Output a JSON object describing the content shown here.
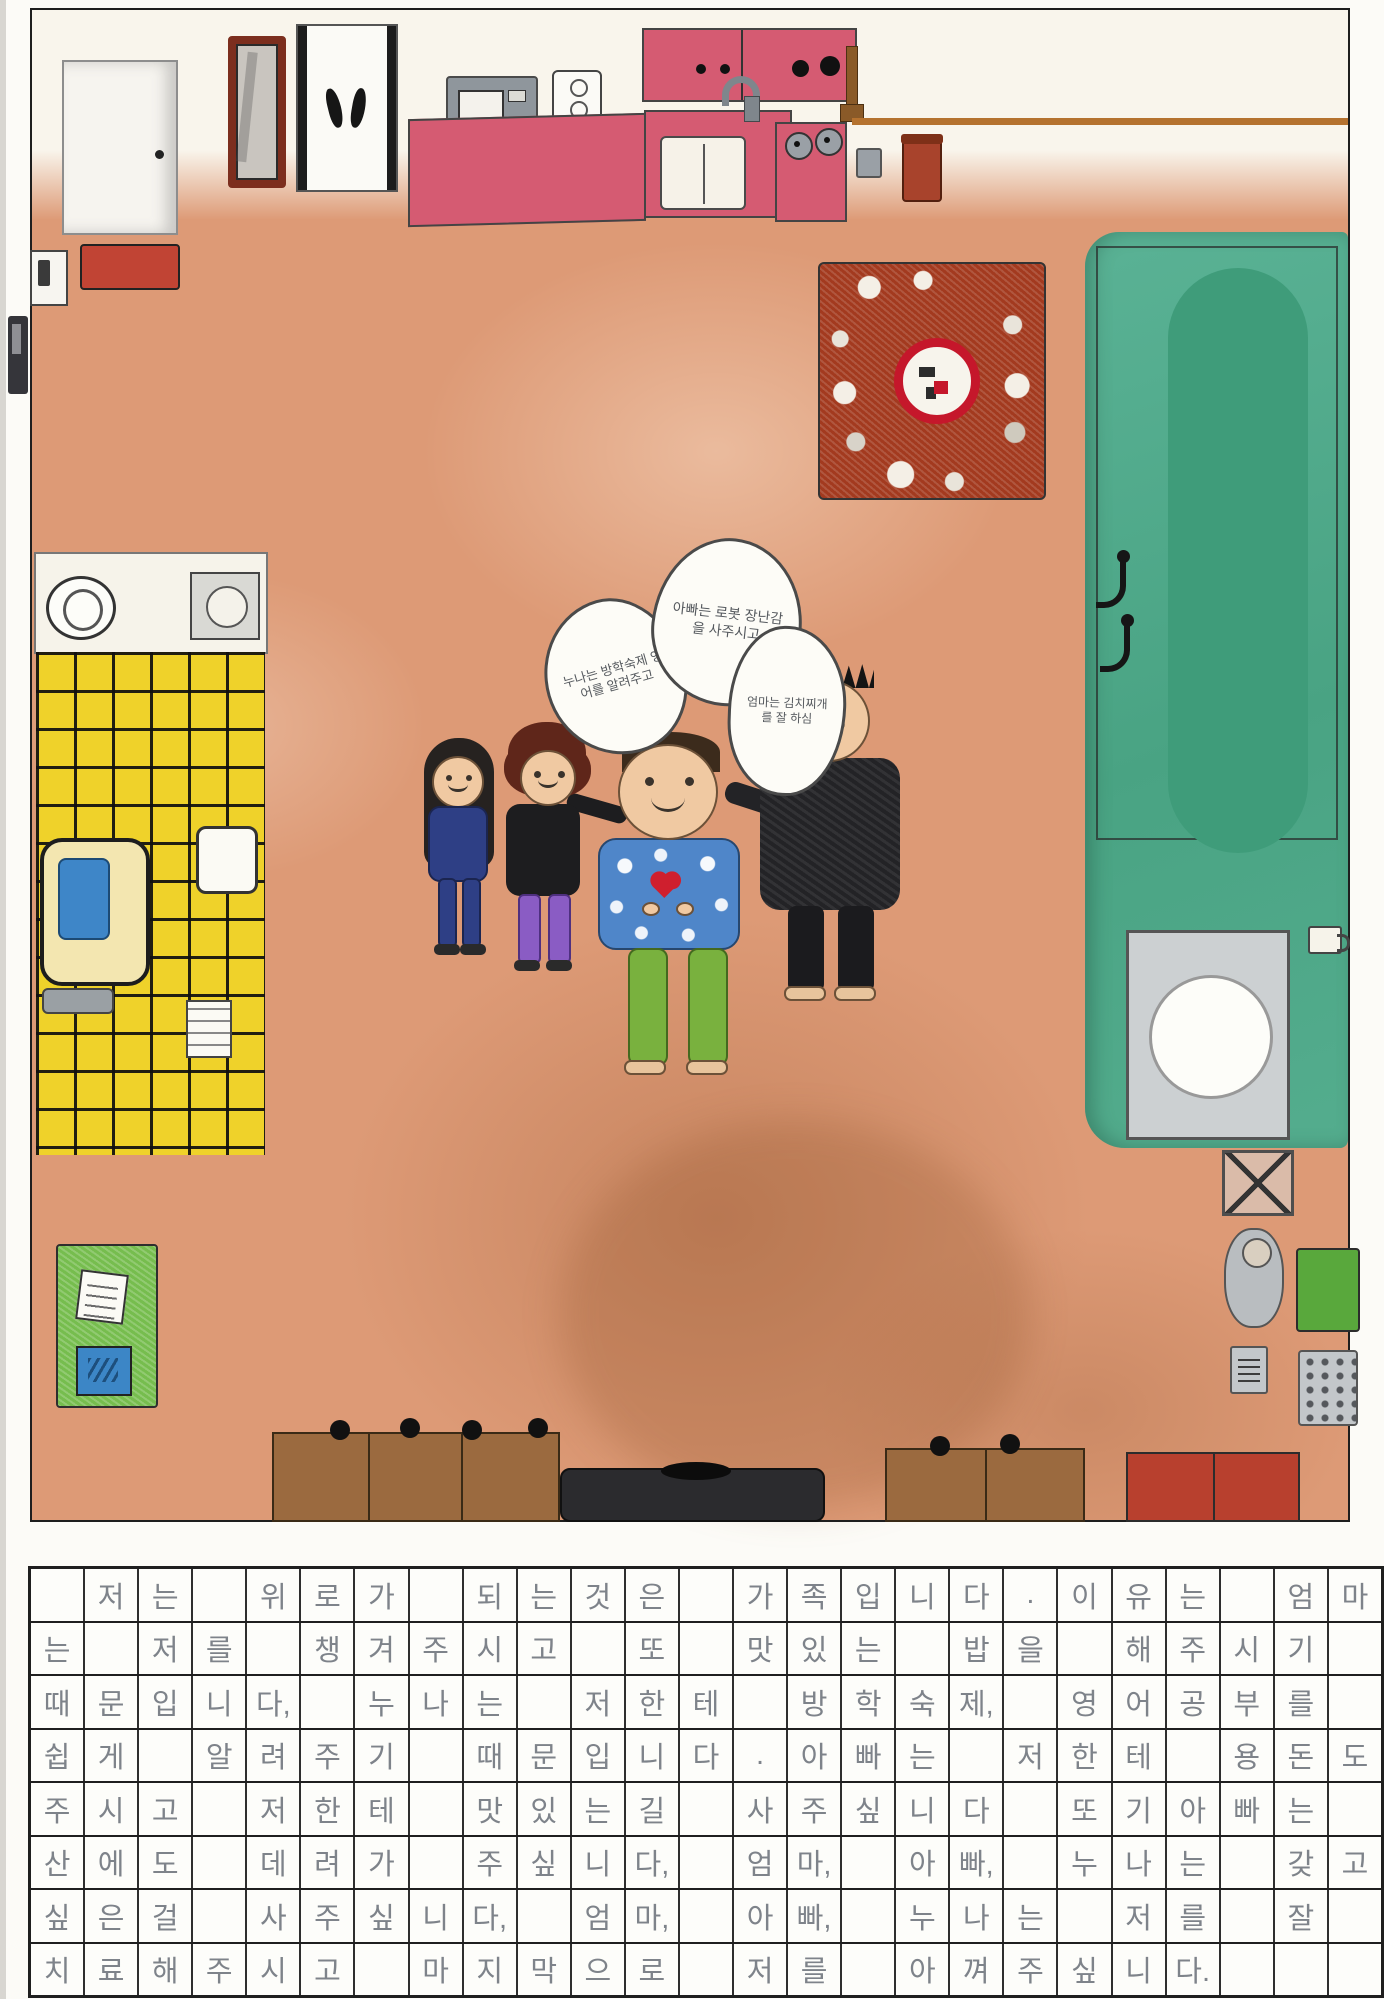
{
  "drawing": {
    "speech_bubbles": {
      "sister_bubble": "누나는 방학숙제 영어를 알려주고",
      "dad_bubble": "아빠는 로봇 장난감을 사주시고",
      "mom_bubble": "엄마는 김치찌개를 잘 하심"
    },
    "palette": {
      "floor": "#DD9A76",
      "wall": "#F9F5EC",
      "kitchen_pink": "#D55B72",
      "bathroom_yellow": "#EFD22A",
      "bedroom_green": "#55B192",
      "table_red": "#A33A1F",
      "mat_red": "#C14434",
      "cabinet_brown": "#9B6A3F",
      "water_blue": "#3E86C8",
      "board_green": "#76BD4E",
      "screen_blue": "#3C86C6",
      "tv_black": "#2B2B2E",
      "pencil_gray": "#7E838A",
      "grid_line": "#1F1F1F"
    }
  },
  "manuscript": {
    "rows": [
      [
        "",
        "저",
        "는",
        "",
        "위",
        "로",
        "가",
        "",
        "되",
        "는",
        "것",
        "은",
        "",
        "가",
        "족",
        "입",
        "니",
        "다",
        ".",
        "이",
        "유",
        "는",
        "",
        "엄",
        "마"
      ],
      [
        "는",
        "",
        "저",
        "를",
        "",
        "챙",
        "겨",
        "주",
        "시",
        "고",
        "",
        "또",
        "",
        "맛",
        "있",
        "는",
        "",
        "밥",
        "을",
        "",
        "해",
        "주",
        "시",
        "기",
        ""
      ],
      [
        "때",
        "문",
        "입",
        "니",
        "다,",
        "",
        "누",
        "나",
        "는",
        "",
        "저",
        "한",
        "테",
        "",
        "방",
        "학",
        "숙",
        "제,",
        "",
        "영",
        "어",
        "공",
        "부",
        "를",
        ""
      ],
      [
        "쉽",
        "게",
        "",
        "알",
        "려",
        "주",
        "기",
        "",
        "때",
        "문",
        "입",
        "니",
        "다",
        ".",
        "아",
        "빠",
        "는",
        "",
        "저",
        "한",
        "테",
        "",
        "용",
        "돈",
        "도"
      ],
      [
        "주",
        "시",
        "고",
        "",
        "저",
        "한",
        "테",
        "",
        "맛",
        "있",
        "는",
        "길",
        "",
        "사",
        "주",
        "싶",
        "니",
        "다",
        "",
        "또",
        "기",
        "아",
        "빠",
        "는",
        ""
      ],
      [
        "산",
        "에",
        "도",
        "",
        "데",
        "려",
        "가",
        "",
        "주",
        "싶",
        "니",
        "다,",
        "",
        "엄",
        "마,",
        "",
        "아",
        "빠,",
        "",
        "누",
        "나",
        "는",
        "",
        "갖",
        "고"
      ],
      [
        "싶",
        "은",
        "걸",
        "",
        "사",
        "주",
        "싶",
        "니",
        "다,",
        "",
        "엄",
        "마,",
        "",
        "아",
        "빠,",
        "",
        "누",
        "나",
        "는",
        "",
        "저",
        "를",
        "",
        "잘",
        ""
      ],
      [
        "치",
        "료",
        "해",
        "주",
        "시",
        "고",
        "",
        "마",
        "지",
        "막",
        "으",
        "로",
        "",
        "저",
        "를",
        "",
        "아",
        "껴",
        "주",
        "싶",
        "니",
        "다.",
        "",
        "",
        ""
      ]
    ],
    "full_text": "저는 위로가 되는 것은 가족입니다. 이유는 엄마는 저를 챙겨주시고 또 맛있는 밥을 해주시기 때문입니다. 누나는 저한테 방학숙제, 영어공부를 쉽게 알려주기 때문입니다. 아빠는 저한테 용돈도 주시고 저한테 맛있는 길 사주싶니다. 또 아빠는 산에도 데려가 주싶니다, 엄마, 아빠, 누나는 갖고 싶은 걸 사주싶니다, 엄마, 아빠, 누나는 저를 잘 치료해주시고 마지막으로 저를 아껴주십니다."
  }
}
